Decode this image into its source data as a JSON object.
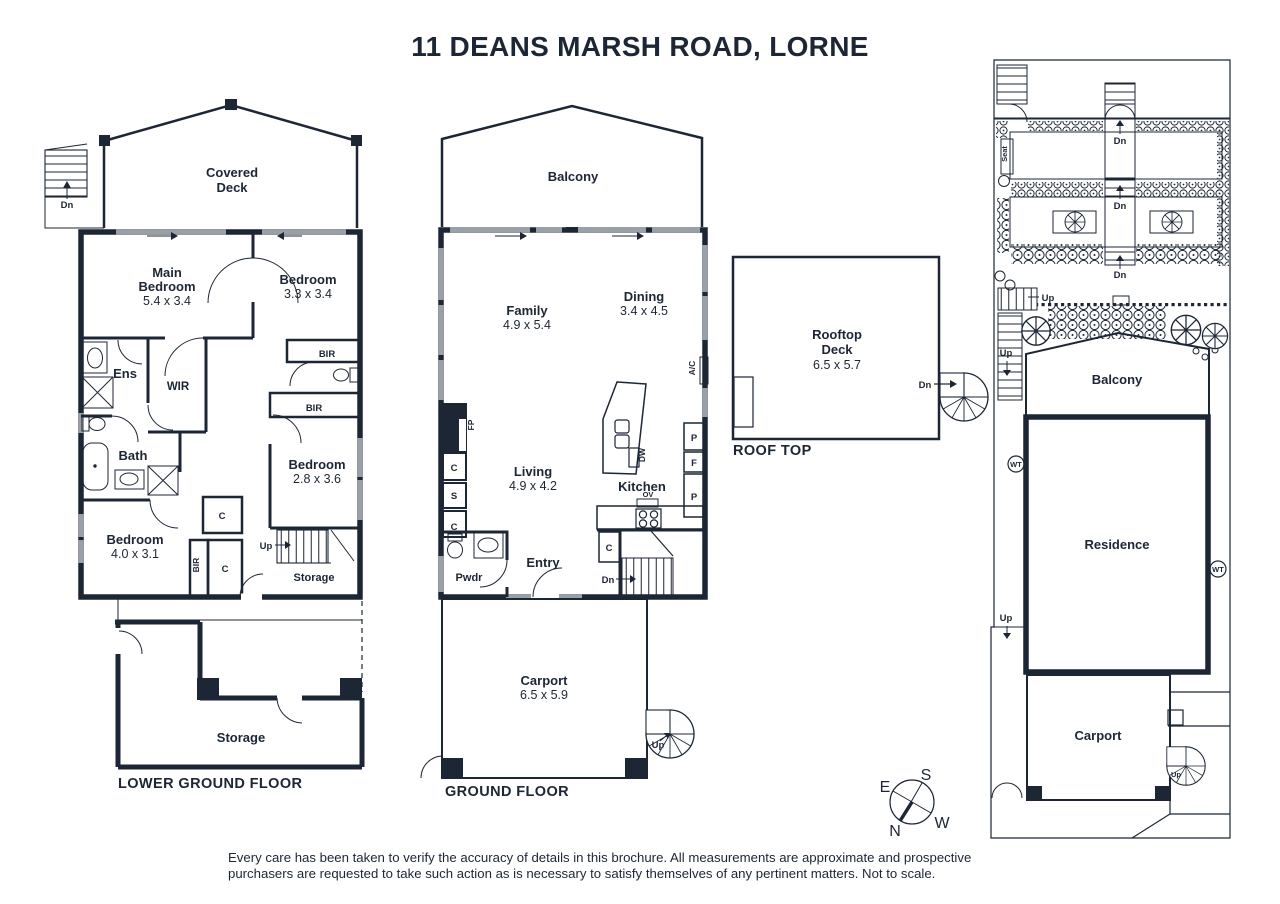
{
  "title": "11 DEANS MARSH ROAD, LORNE",
  "colors": {
    "ink": "#1c2634",
    "window_gray": "#9aa0a8"
  },
  "lg": {
    "caption": "LOWER GROUND FLOOR",
    "deck_l1": "Covered",
    "deck_l2": "Deck",
    "main_l1": "Main",
    "main_l2": "Bedroom",
    "main_d": "5.4 x 3.4",
    "bed2": "Bedroom",
    "bed2_d": "3.3 x 3.4",
    "bed3": "Bedroom",
    "bed3_d": "2.8 x 3.6",
    "bed4": "Bedroom",
    "bed4_d": "4.0 x 3.1",
    "ens": "Ens",
    "wir": "WIR",
    "bath": "Bath",
    "storage": "Storage",
    "storage_lower": "Storage"
  },
  "gf": {
    "caption": "GROUND FLOOR",
    "balcony": "Balcony",
    "family": "Family",
    "family_d": "4.9 x 5.4",
    "dining": "Dining",
    "dining_d": "3.4 x 4.5",
    "living": "Living",
    "living_d": "4.9 x 4.2",
    "kitchen": "Kitchen",
    "entry": "Entry",
    "pwdr": "Pwdr",
    "carport": "Carport",
    "carport_d": "6.5 x 5.9"
  },
  "rt": {
    "caption": "ROOF TOP",
    "deck_l1": "Rooftop",
    "deck_l2": "Deck",
    "deck_d": "6.5 x 5.7"
  },
  "site": {
    "balcony": "Balcony",
    "residence": "Residence",
    "carport": "Carport",
    "seat": "Seat",
    "wt": "WT"
  },
  "labels": {
    "dn": "Dn",
    "up": "Up",
    "bir": "BIR",
    "c": "C",
    "s": "S",
    "p": "P",
    "f": "F",
    "ov": "OV",
    "dw": "DW",
    "ac": "A/C",
    "fp": "FP"
  },
  "compass": {
    "n": "N",
    "s": "S",
    "e": "E",
    "w": "W"
  },
  "disclaimer": {
    "line1": "Every care has been taken to verify the accuracy of details in this brochure. All measurements are approximate and prospective",
    "line2": "purchasers are requested to take such action as is necessary to satisfy themselves of any pertinent matters. Not to scale."
  }
}
